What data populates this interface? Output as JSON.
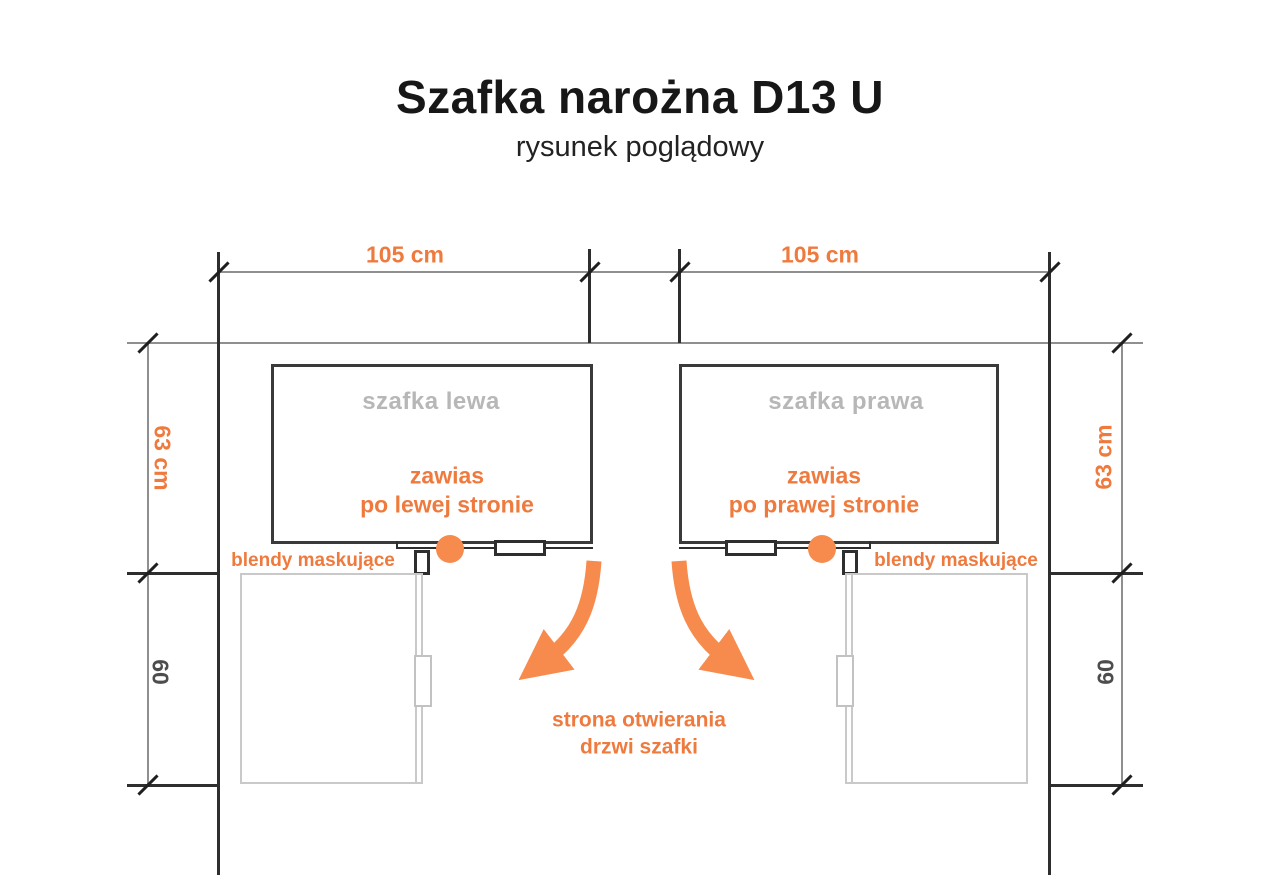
{
  "title": "Szafka narożna D13 U",
  "subtitle": "rysunek poglądowy",
  "colors": {
    "accent_orange_text": "#EF7A3E",
    "accent_orange_arrow": "#F78B4D",
    "line_dark": "#2e2e2e",
    "line_thin": "#8f8f8f",
    "gray_cabinet": "#c9c9c9",
    "gray_label": "#b7b7b7"
  },
  "dimensions": {
    "top_left_width": "105 cm",
    "top_right_width": "105 cm",
    "side_left_depth": "63 cm",
    "side_right_depth": "63 cm",
    "bottom_left_depth": "60",
    "bottom_right_depth": "60"
  },
  "cabinets": {
    "left": {
      "label": "szafka lewa",
      "hinge_note_line1": "zawias",
      "hinge_note_line2": "po lewej stronie"
    },
    "right": {
      "label": "szafka prawa",
      "hinge_note_line1": "zawias",
      "hinge_note_line2": "po prawej stronie"
    }
  },
  "annotations": {
    "blendy_left": "blendy maskujące",
    "blendy_right": "blendy maskujące",
    "opening_note_line1": "strona otwierania",
    "opening_note_line2": "drzwi szafki"
  }
}
